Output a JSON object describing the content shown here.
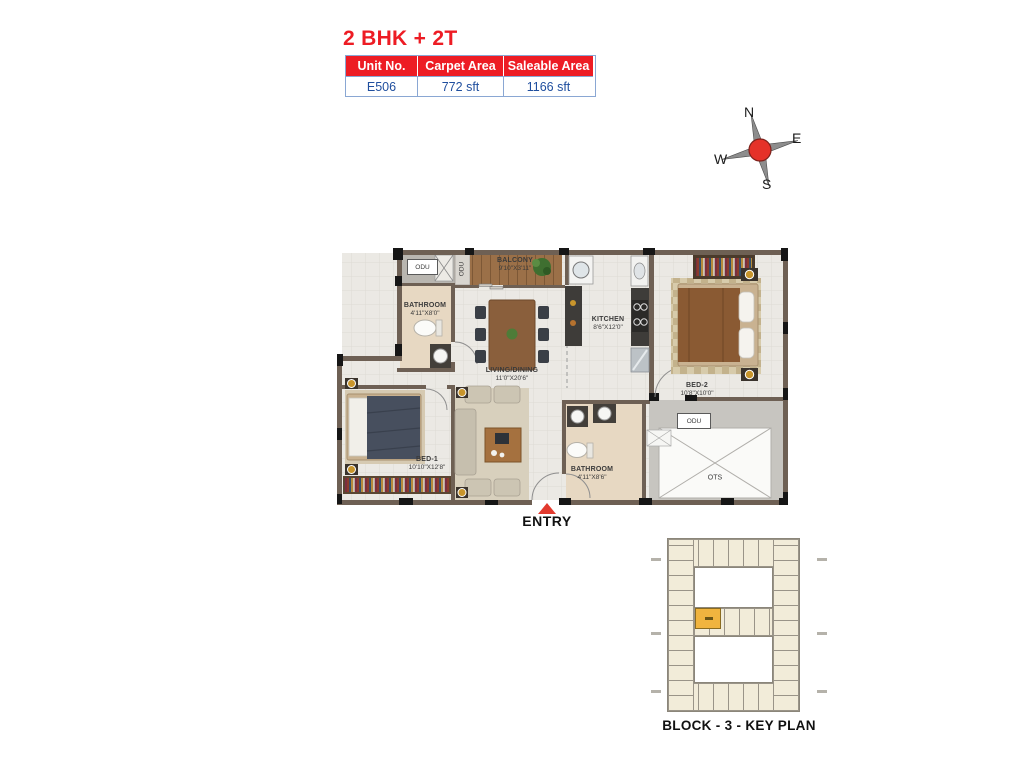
{
  "header": {
    "title": "2 BHK + 2T",
    "table": {
      "columns": [
        "Unit No.",
        "Carpet Area",
        "Saleable Area"
      ],
      "values": [
        "E506",
        "772 sft",
        "1166 sft"
      ]
    }
  },
  "compass": {
    "north": "N",
    "east": "E",
    "south": "S",
    "west": "W"
  },
  "floor_plan": {
    "rooms": {
      "balcony": {
        "name": "BALCONY",
        "dims": "9'10\"X3'11\""
      },
      "bathroom1": {
        "name": "BATHROOM",
        "dims": "4'11\"X8'0\""
      },
      "living_dining": {
        "name": "LIVING/DINING",
        "dims": "11'0\"X20'6\""
      },
      "kitchen": {
        "name": "KITCHEN",
        "dims": "8'6\"X12'0\""
      },
      "bed2": {
        "name": "BED-2",
        "dims": "10'8\"X10'0\""
      },
      "bed1": {
        "name": "BED-1",
        "dims": "10'10\"X12'8\""
      },
      "bathroom2": {
        "name": "BATHROOM",
        "dims": "4'11\"X8'6\""
      }
    },
    "odu_label": "ODU",
    "ots_label": "OTS",
    "entry_label": "ENTRY"
  },
  "key_plan": {
    "caption": "BLOCK - 3 - KEY PLAN"
  },
  "colors": {
    "accent_red": "#ED1C24",
    "value_blue": "#1F4E9E",
    "wall_brown": "#6E6054",
    "keyplan_highlight": "#F0B43F"
  }
}
